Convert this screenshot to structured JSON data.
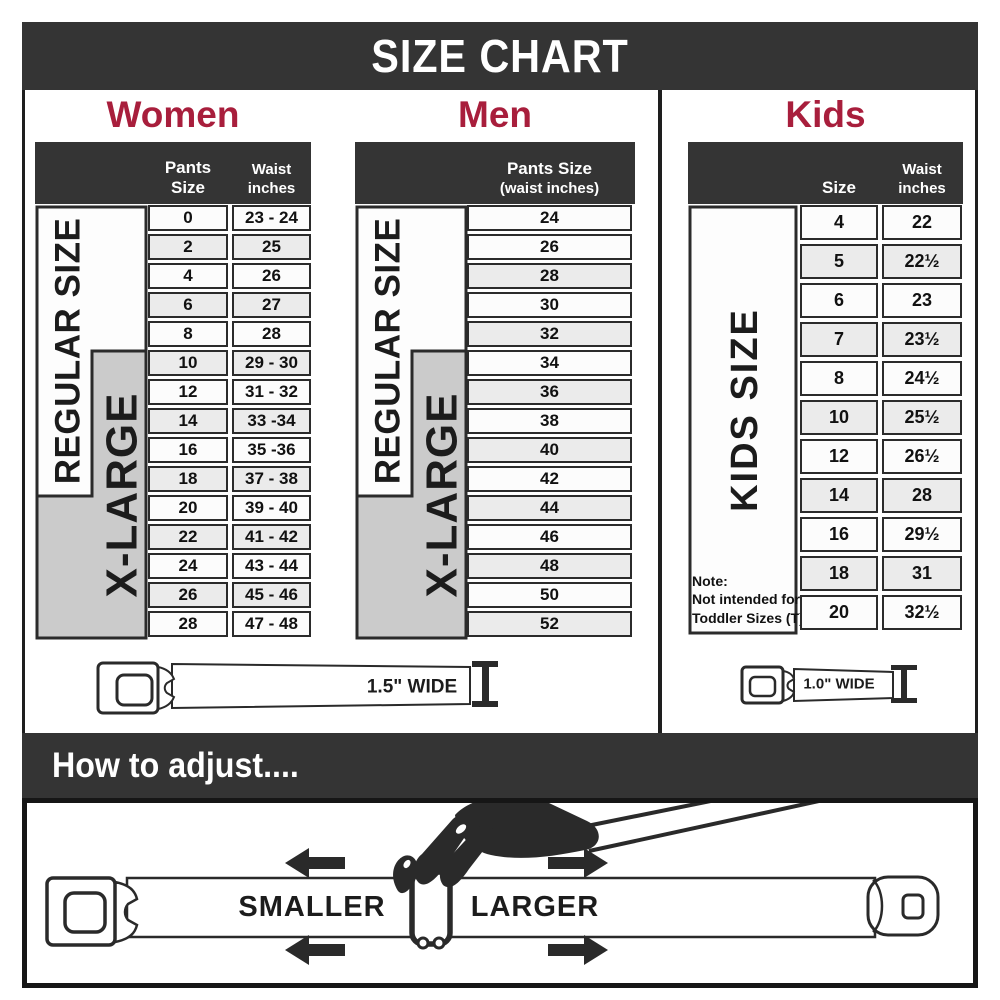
{
  "title": "SIZE CHART",
  "colors": {
    "accent": "#a81e3c",
    "bar": "#343434",
    "zone_gray": "#cbcbcb"
  },
  "sections": {
    "women": {
      "title": "Women",
      "col1_header": "Pants Size",
      "col2_header": {
        "line1": "Waist",
        "line2": "inches"
      },
      "zones": {
        "regular": "REGULAR SIZE",
        "xlarge": "X-LARGE"
      },
      "rows": [
        {
          "size": "0",
          "waist": "23 - 24"
        },
        {
          "size": "2",
          "waist": "25"
        },
        {
          "size": "4",
          "waist": "26"
        },
        {
          "size": "6",
          "waist": "27"
        },
        {
          "size": "8",
          "waist": "28"
        },
        {
          "size": "10",
          "waist": "29 - 30"
        },
        {
          "size": "12",
          "waist": "31 - 32"
        },
        {
          "size": "14",
          "waist": "33 -34"
        },
        {
          "size": "16",
          "waist": "35 -36"
        },
        {
          "size": "18",
          "waist": "37 - 38"
        },
        {
          "size": "20",
          "waist": "39 - 40"
        },
        {
          "size": "22",
          "waist": "41 - 42"
        },
        {
          "size": "24",
          "waist": "43 - 44"
        },
        {
          "size": "26",
          "waist": "45 - 46"
        },
        {
          "size": "28",
          "waist": "47 - 48"
        }
      ]
    },
    "men": {
      "title": "Men",
      "col_header": {
        "line1": "Pants Size",
        "line2": "(waist inches)"
      },
      "zones": {
        "regular": "REGULAR SIZE",
        "xlarge": "X-LARGE"
      },
      "rows": [
        "24",
        "26",
        "28",
        "30",
        "32",
        "34",
        "36",
        "38",
        "40",
        "42",
        "44",
        "46",
        "48",
        "50",
        "52"
      ]
    },
    "kids": {
      "title": "Kids",
      "col1_header": "Size",
      "col2_header": {
        "line1": "Waist",
        "line2": "inches"
      },
      "zone_label": "KIDS SIZE",
      "note": {
        "line1": "Note:",
        "line2": "Not intended for",
        "line3": "Toddler Sizes (T)"
      },
      "rows": [
        {
          "size": "4",
          "waist": "22"
        },
        {
          "size": "5",
          "waist": "22½"
        },
        {
          "size": "6",
          "waist": "23"
        },
        {
          "size": "7",
          "waist": "23½"
        },
        {
          "size": "8",
          "waist": "24½"
        },
        {
          "size": "10",
          "waist": "25½"
        },
        {
          "size": "12",
          "waist": "26½"
        },
        {
          "size": "14",
          "waist": "28"
        },
        {
          "size": "16",
          "waist": "29½"
        },
        {
          "size": "18",
          "waist": "31"
        },
        {
          "size": "20",
          "waist": "32½"
        }
      ]
    }
  },
  "belts": {
    "adult_label": "1.5\" WIDE",
    "kids_label": "1.0\" WIDE"
  },
  "adjust": {
    "heading": "How to adjust....",
    "smaller": "SMALLER",
    "larger": "LARGER"
  }
}
